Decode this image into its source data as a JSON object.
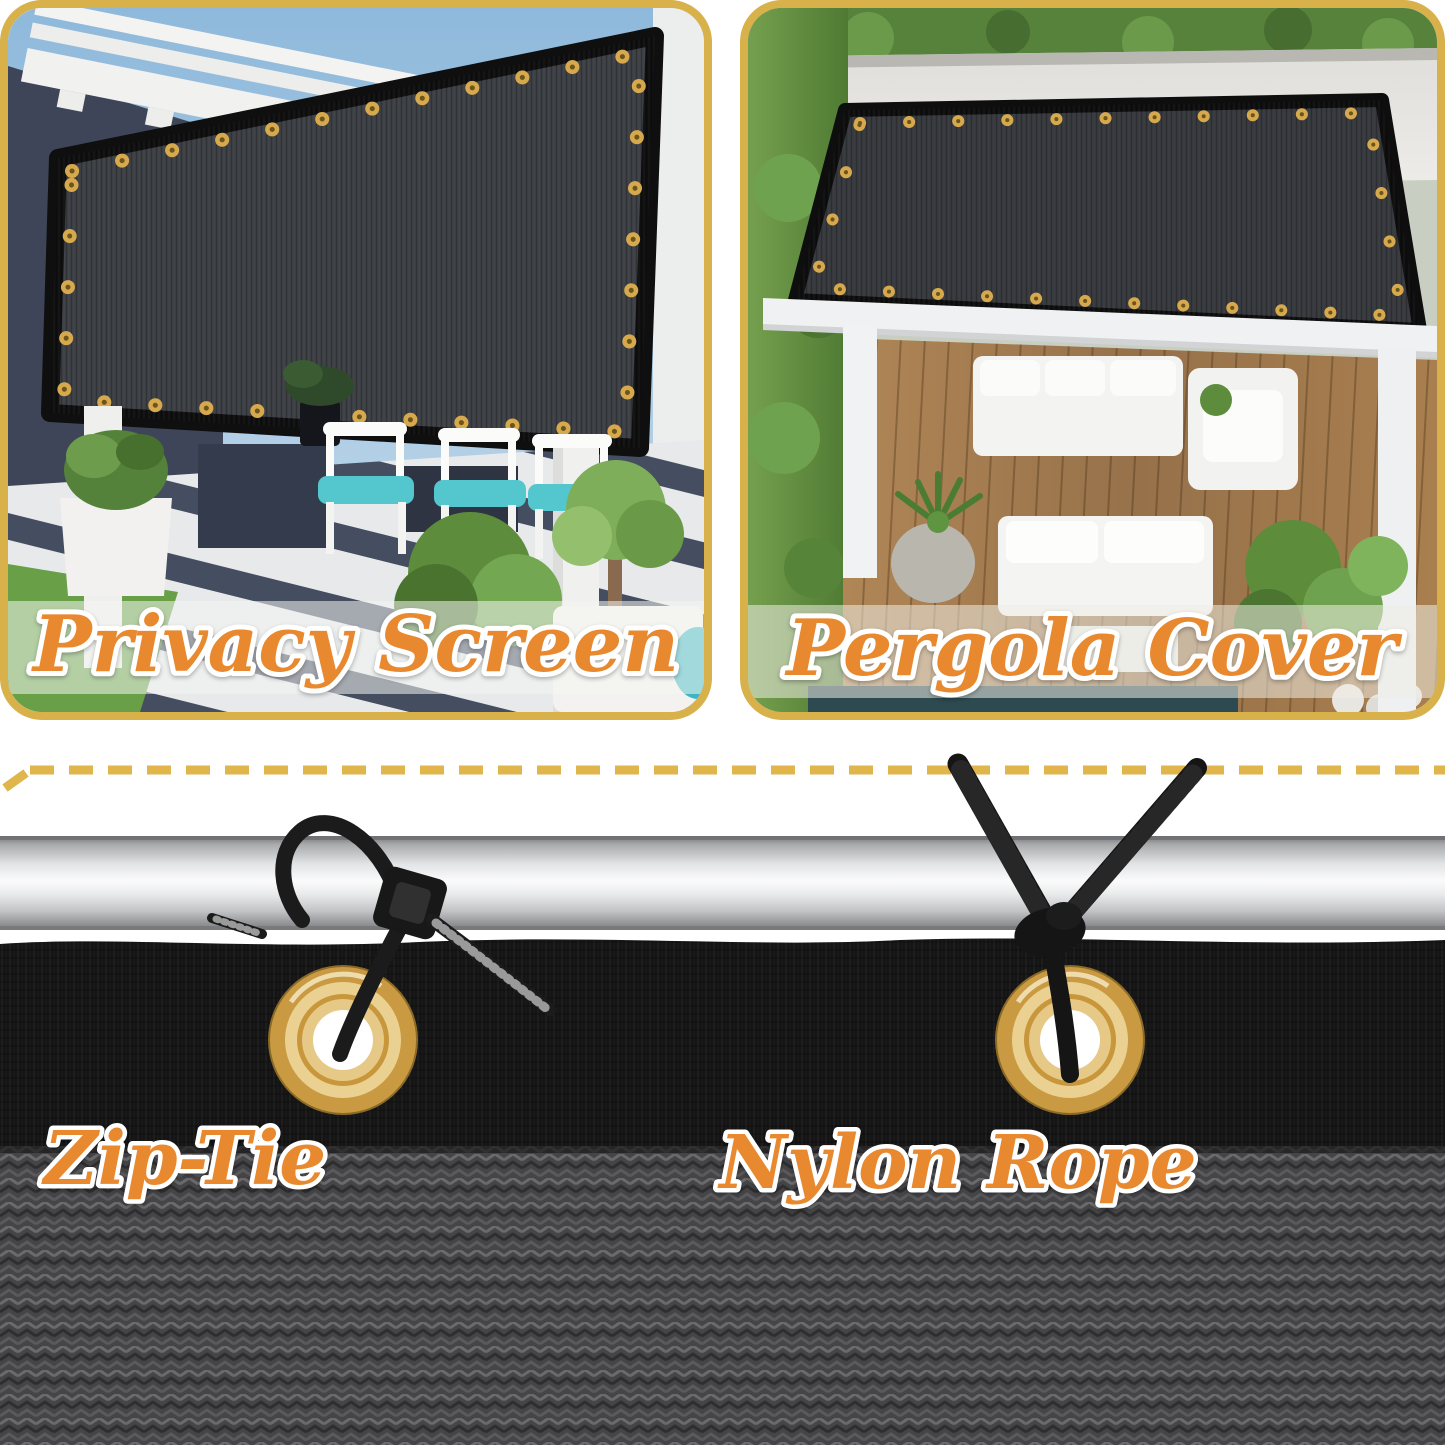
{
  "panels": {
    "left_caption": "Privacy Screen",
    "right_caption": "Pergola Cover"
  },
  "fastening": {
    "zip_tie_label": "Zip-Tie",
    "nylon_rope_label": "Nylon Rope"
  },
  "colors": {
    "frame_gold": "#D8B14B",
    "dash_gold": "#DFB54C",
    "caption_orange": "#E8892F",
    "caption_outline": "#FFFFFF",
    "mesh_dark": "#3B3E42",
    "mesh_border": "#0F0F0F",
    "grommet_gold": "#D7A94E",
    "grommet_center": "#6B5518",
    "rail_silver": "#D9DADC",
    "fabric_black": "#161616",
    "fabric_weave_gray": "#47474A",
    "rope_black": "#171717",
    "sky_blue": "#8FB9DB",
    "wall_navy": "#3E4558",
    "deck_wood": "#A87C4E",
    "pool_teal": "#2C4A50",
    "cushion_teal": "#53C6CE"
  }
}
